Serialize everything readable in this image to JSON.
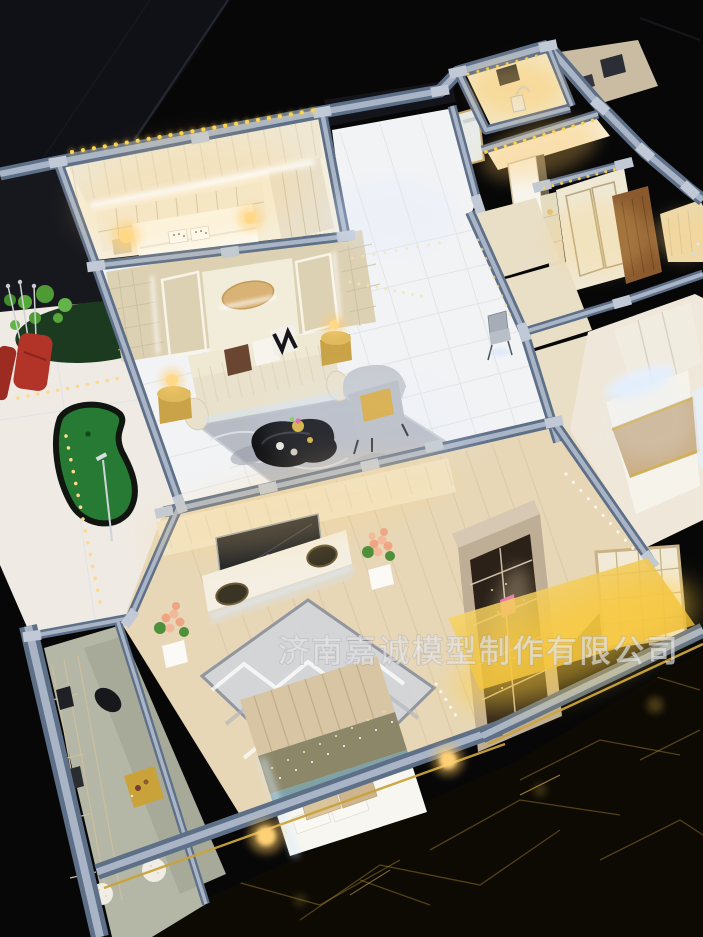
{
  "scene": {
    "description": "Illuminated miniature apartment scale model photographed from above on a black glass table with crinkled gold-foil base",
    "watermark_text": "济南嘉诚模型制作有限公司"
  },
  "palette": {
    "bg": "#070708",
    "glassDark": "#101117",
    "glassEdge": "#2a2e38",
    "wallSlate": "#5e6f88",
    "wallCap": "#a9b5c7",
    "capTab": "#c0c9d5",
    "cream": "#ece3cd",
    "creamDeep": "#ddd1b4",
    "warmWall": "#f4e8c8",
    "tile": "#f2f3f5",
    "tileLine": "#dfe2e7",
    "woodFloor": "#e7d7b7",
    "woodLine": "#d3bf9c",
    "benchFloor": "#b4b6a6",
    "benchTop": "#a7aa99",
    "sofaCream": "#e9e1cb",
    "rugMarble": "#b7bbc4",
    "rugBed": "#d4d5d9",
    "gold": "#c9a23a",
    "goldSoft": "#e2c270",
    "warmLight": "#ffd98c",
    "warmGlow": "#ffc64a",
    "coolLight": "#d9e9ff",
    "golfGreen": "#267a33",
    "golfDark": "#12471c",
    "leafGreen": "#57a83b",
    "bagRed": "#b23429",
    "tealBand": "#7fa2a6",
    "sequin": "#8d8769",
    "champagne": "#d8c5a4",
    "duvetWhite": "#f7f6f0",
    "doorBrown": "#8a5a2e",
    "screenDark": "#1d2026",
    "foilBase": "#0d0a04",
    "foilGold": "#a8842e",
    "white": "#fbfaf6",
    "watermark": "rgba(255,255,255,0.55)",
    "watermarkStroke": "rgba(110,110,120,0.4)"
  },
  "objects": [
    "master-bedroom",
    "study-nook",
    "bathroom",
    "entry-wardrobe",
    "front-door",
    "living-room",
    "tv-feature-wall",
    "sofa",
    "coffee-table",
    "armchair",
    "area-rug",
    "balcony",
    "putting-green",
    "golf-bag",
    "potted-plant",
    "main-bedroom",
    "tv-console",
    "wall-tv",
    "bed",
    "display-cabinet",
    "window-bench",
    "second-bedroom",
    "wardrobe",
    "base-table"
  ]
}
